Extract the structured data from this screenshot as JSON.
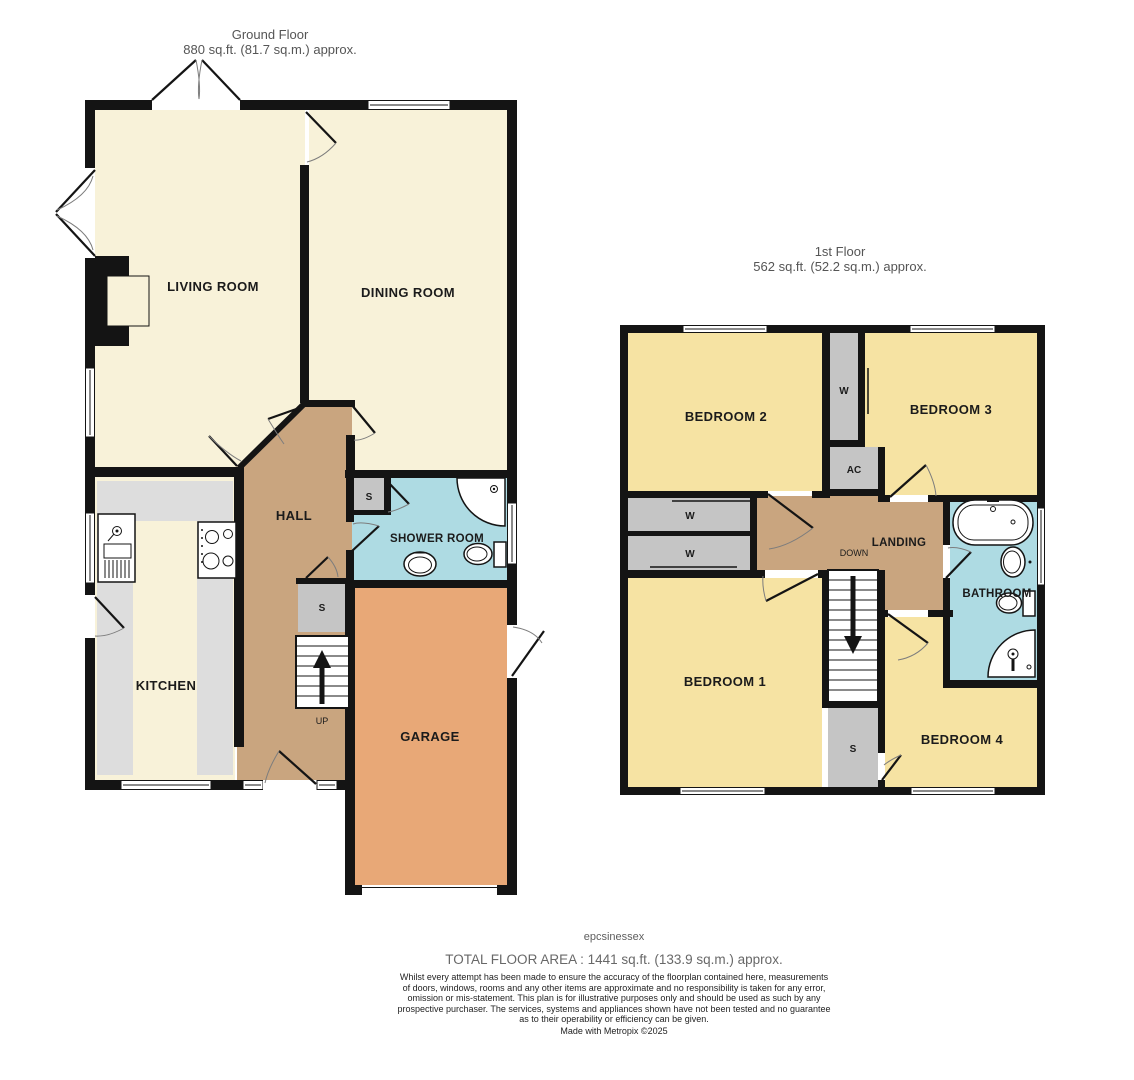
{
  "ground_floor": {
    "title": "Ground Floor",
    "area": "880 sq.ft. (81.7 sq.m.) approx.",
    "rooms": {
      "living": "LIVING ROOM",
      "dining": "DINING ROOM",
      "hall": "HALL",
      "shower": "SHOWER ROOM",
      "kitchen": "KITCHEN",
      "garage": "GARAGE"
    },
    "labels": {
      "store_hall": "S",
      "store_shower": "S",
      "stairs_up": "UP"
    }
  },
  "first_floor": {
    "title": "1st Floor",
    "area": "562 sq.ft. (52.2 sq.m.) approx.",
    "rooms": {
      "bedroom1": "BEDROOM 1",
      "bedroom2": "BEDROOM 2",
      "bedroom3": "BEDROOM 3",
      "bedroom4": "BEDROOM 4",
      "landing": "LANDING",
      "bathroom": "BATHROOM"
    },
    "labels": {
      "wardrobe_top": "W",
      "airing_cupboard": "AC",
      "wardrobe_left_1": "W",
      "wardrobe_left_2": "W",
      "store": "S",
      "stairs_down": "DOWN"
    }
  },
  "footer": {
    "brand": "epcsinessex",
    "total_area": "TOTAL FLOOR AREA : 1441 sq.ft. (133.9 sq.m.) approx.",
    "disclaimer": "Whilst every attempt has been made to ensure the accuracy of the floorplan contained here, measurements of doors, windows, rooms and any other items are approximate and no responsibility is taken for any error, omission or mis-statement. This plan is for illustrative purposes only and should be used as such by any prospective purchaser. The services, systems and appliances shown have not been tested and no guarantee as to their operability or efficiency can be given.",
    "credit": "Made with Metropix ©2025"
  },
  "colors": {
    "wall": "#141414",
    "room_cream": "#f8f2d9",
    "room_yellow": "#f6e3a3",
    "hall_tan": "#c9a57f",
    "garage_orange": "#e8a877",
    "bath_blue": "#aedbe3",
    "closet_gray": "#c5c5c5",
    "counter_gray": "#dddddd"
  }
}
